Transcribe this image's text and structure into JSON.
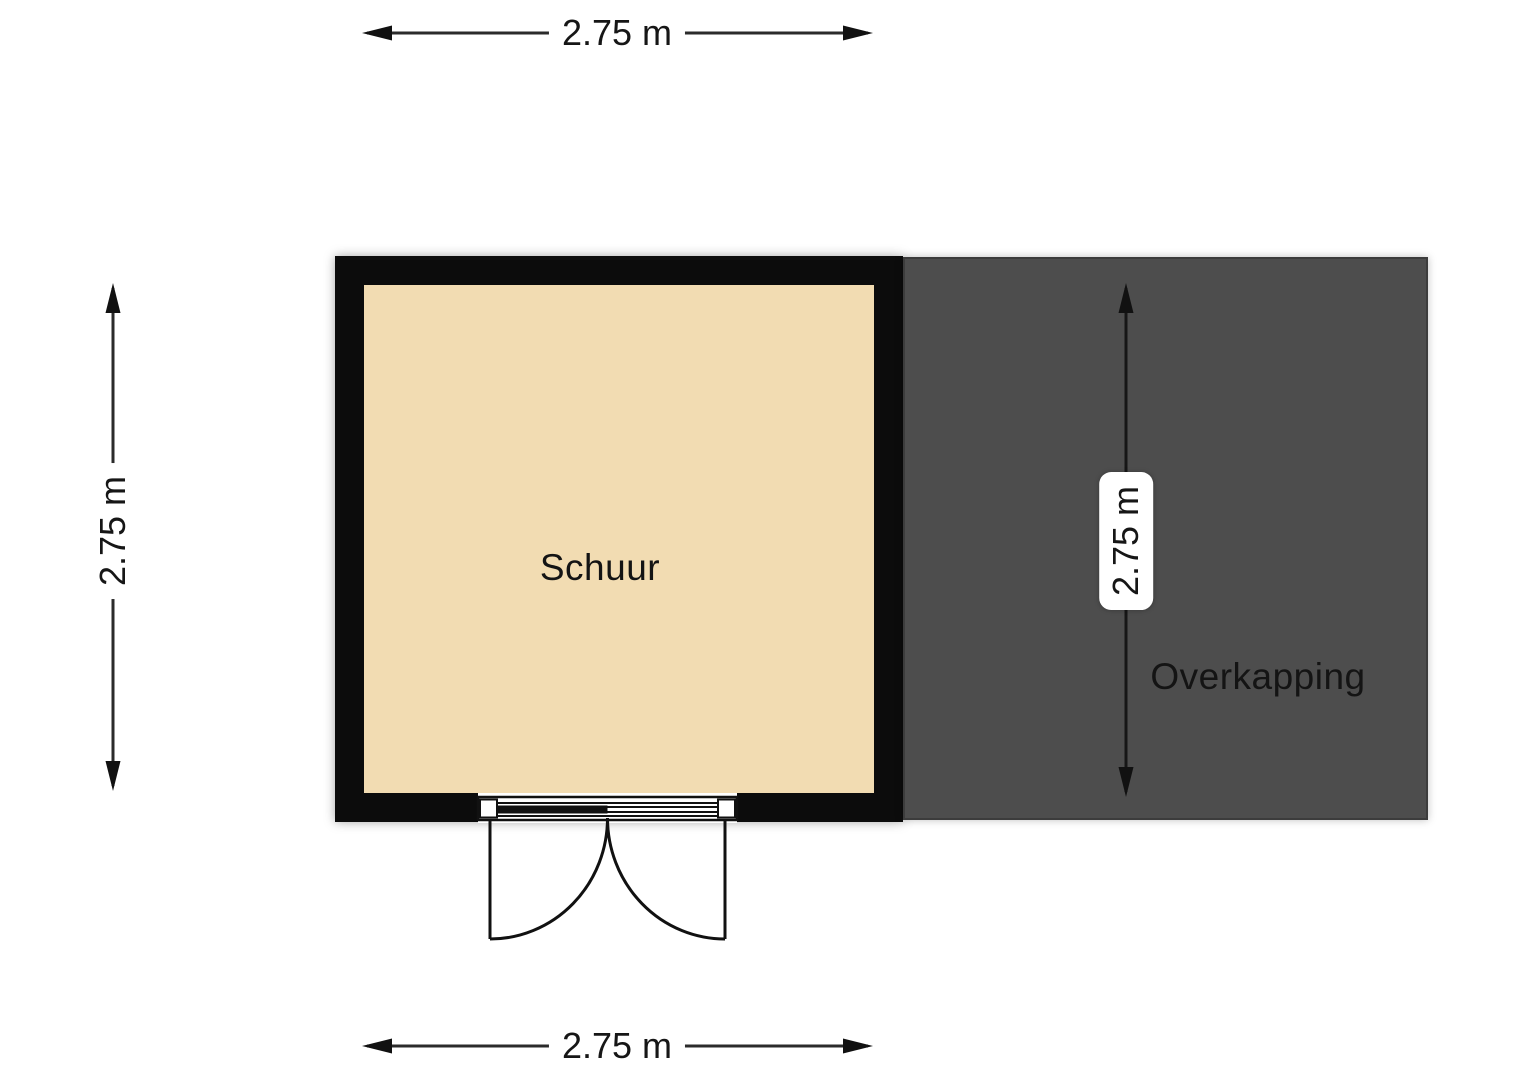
{
  "floorplan": {
    "rooms": [
      {
        "name": "shed",
        "label": "Schuur",
        "floor_color": "#f2dcb2",
        "wall_color": "#0c0c0c"
      },
      {
        "name": "canopy",
        "label": "Overkapping",
        "fill_color": "#4d4d4d"
      }
    ],
    "dimensions": {
      "top": "2.75 m",
      "bottom": "2.75 m",
      "left": "2.75 m",
      "overkapping": "2.75 m"
    },
    "features": [
      {
        "name": "double-door",
        "location": "shed bottom wall"
      }
    ],
    "colors": {
      "background": "#ffffff",
      "dimension_line": "#2b2b2b",
      "text": "#141414"
    }
  }
}
